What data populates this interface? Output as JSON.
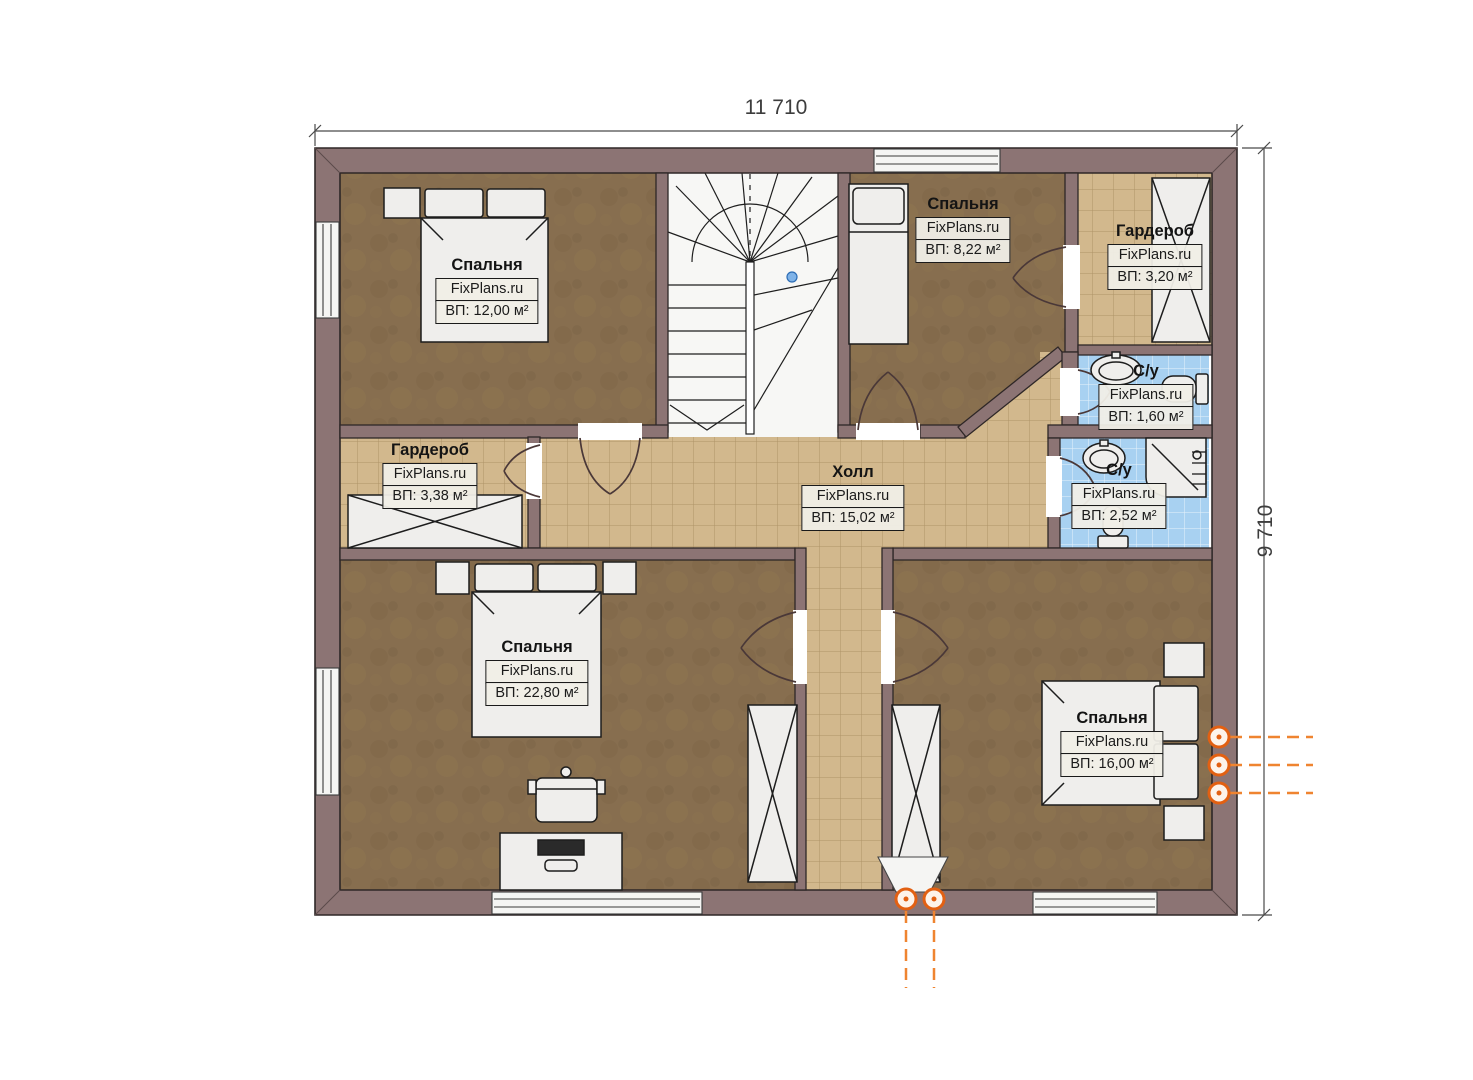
{
  "watermark": "FixPlans.ru",
  "dimensions": {
    "width": "11 710",
    "height": "9 710"
  },
  "rooms": [
    {
      "id": "bedroom-top-left",
      "name": "Спальня",
      "area": "ВП: 12,00 м²"
    },
    {
      "id": "bedroom-top-middle",
      "name": "Спальня",
      "area": "ВП: 8,22 м²"
    },
    {
      "id": "wardrobe-top-right",
      "name": "Гардероб",
      "area": "ВП: 3,20 м²"
    },
    {
      "id": "bathroom-small",
      "name": "С/у",
      "area": "ВП: 1,60 м²"
    },
    {
      "id": "bathroom-large",
      "name": "С/у",
      "area": "ВП: 2,52 м²"
    },
    {
      "id": "wardrobe-left",
      "name": "Гардероб",
      "area": "ВП: 3,38 м²"
    },
    {
      "id": "hall",
      "name": "Холл",
      "area": "ВП: 15,02 м²"
    },
    {
      "id": "bedroom-bottom-left",
      "name": "Спальня",
      "area": "ВП: 22,80 м²"
    },
    {
      "id": "bedroom-bottom-right",
      "name": "Спальня",
      "area": "ВП: 16,00 м²"
    }
  ],
  "colors": {
    "wall": "#8c7474",
    "wood_floor": "#876e4f",
    "tile_beige": "#d2b88d",
    "tile_blue": "#a8d1f1",
    "accent_orange": "#e26012"
  }
}
